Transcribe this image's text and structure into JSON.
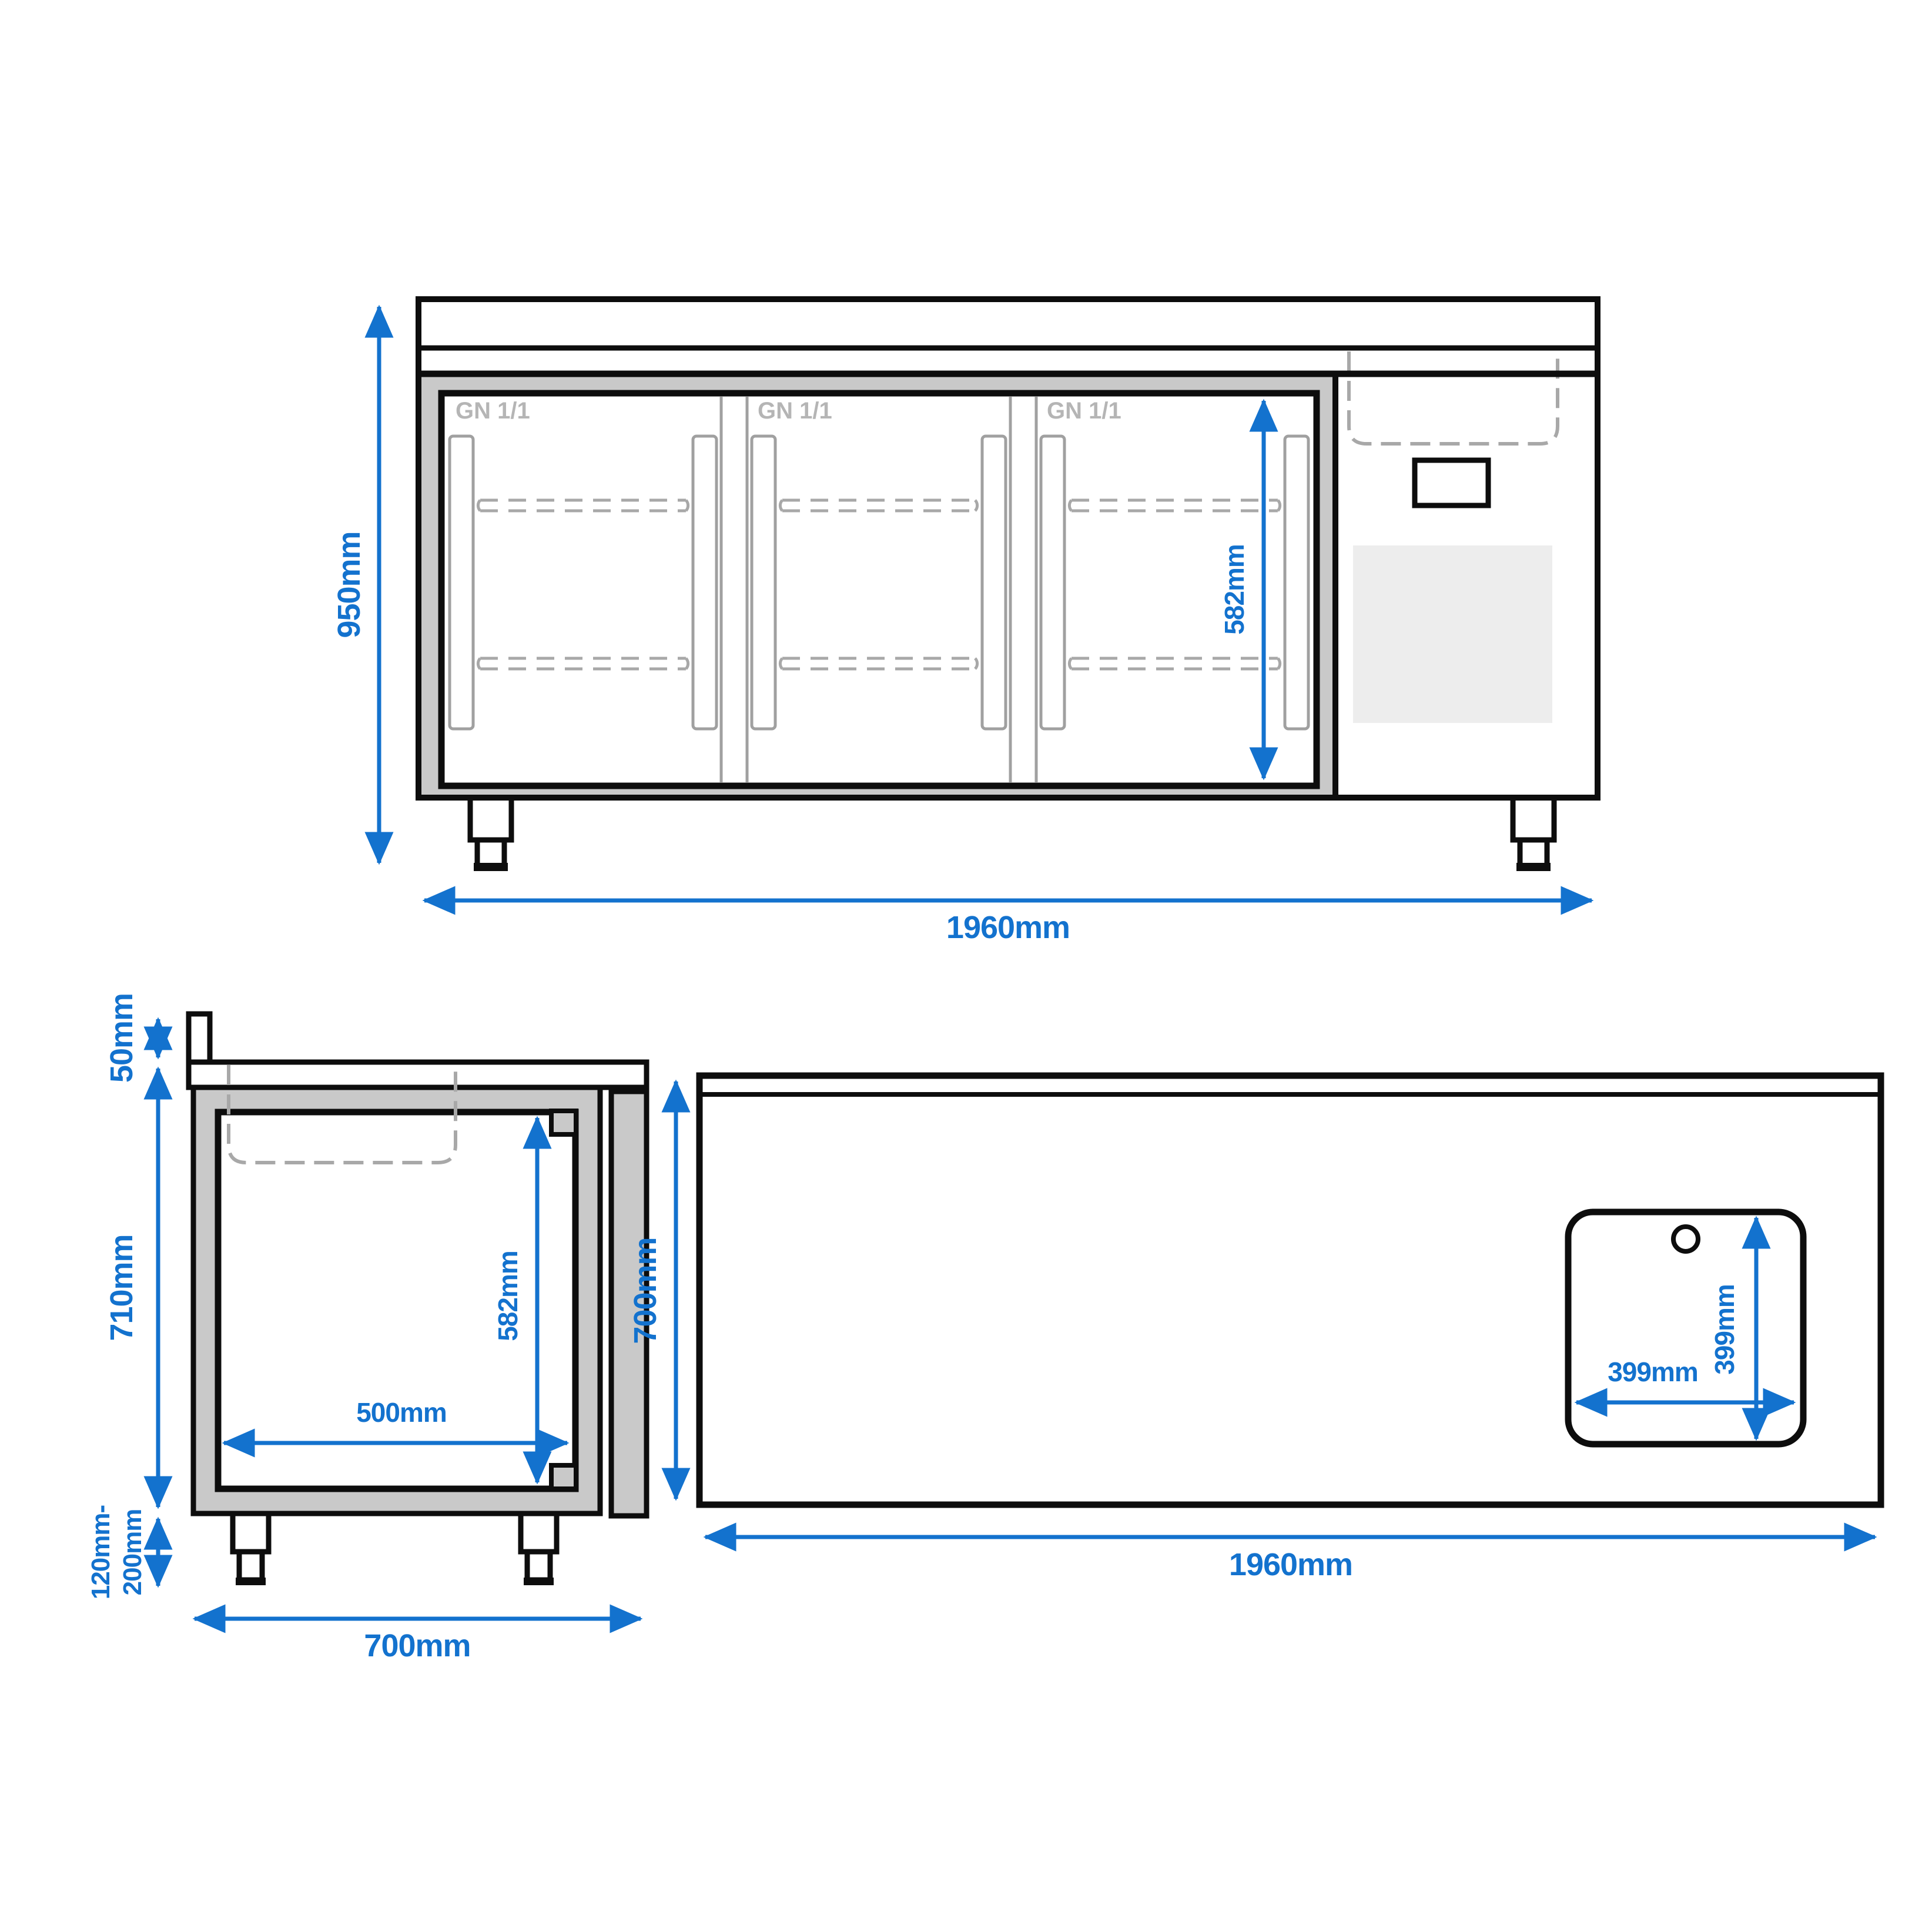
{
  "colors": {
    "dimension_blue": "#1372ce",
    "line_black": "#0d0d0d",
    "wall_gray": "#c9c9c9",
    "detail_gray": "#a0a0a0",
    "dashed_gray": "#a8a8a8",
    "label_gray": "#b5b5b5",
    "vent_gray": "#ededed"
  },
  "front_view": {
    "door_labels": [
      "GN 1/1",
      "GN 1/1",
      "GN 1/1"
    ],
    "dim_height": "950mm",
    "dim_width": "1960mm",
    "dim_interior_height": "582mm"
  },
  "side_view": {
    "dim_upstand": "50mm",
    "dim_body_height": "710mm",
    "dim_leg_height": [
      "120mm-",
      "200mm"
    ],
    "dim_depth": "700mm",
    "dim_interior_height": "582mm",
    "dim_interior_depth": "500mm"
  },
  "top_view": {
    "dim_depth": "700mm",
    "dim_width": "1960mm",
    "dim_sink_width": "399mm",
    "dim_sink_depth": "399mm"
  }
}
